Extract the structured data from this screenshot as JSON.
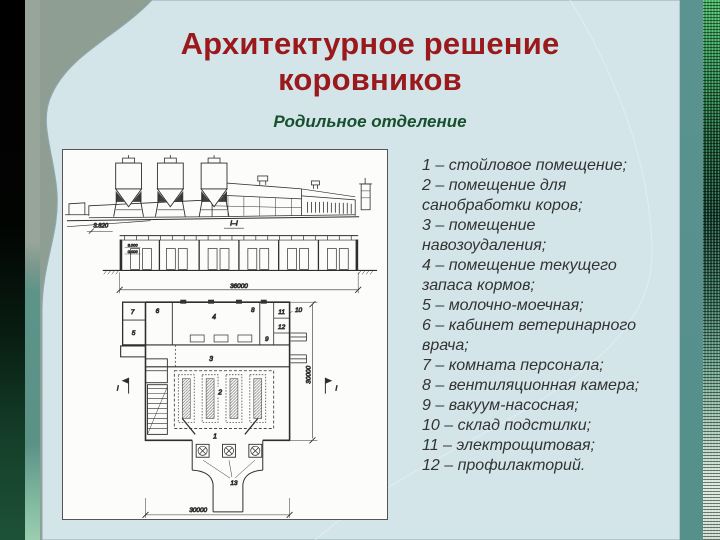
{
  "slide": {
    "title": "Архитектурное решение коровников",
    "subtitle": "Родильное отделение"
  },
  "legend": {
    "items": [
      "1 – стойловое помещение;",
      "2 – помещение для санобработки коров;",
      "3 – помещение навозоудаления;",
      "4 – помещение текущего запаса кормов;",
      "5 – молочно-моечная;",
      "6 – кабинет ветеринарного врача;",
      "7 – комната персонала;",
      "8 – вентиляционная камера;",
      "9 – вакуум-насосная;",
      "10 – склад подстилки;",
      "11 – электрощитовая;",
      "12 – профилакторий."
    ]
  },
  "drawing": {
    "section_mark": "I–I",
    "level_note": "3.820",
    "levels": {
      "upper": "3.000",
      "lower": "0.000"
    },
    "dim_section": "36000",
    "dim_plan_bottom": "30000",
    "dim_plan_right": "30000",
    "marker": "I",
    "rooms": {
      "r1": "1",
      "r2": "2",
      "r3": "3",
      "r4": "4",
      "r5": "5",
      "r6": "6",
      "r7": "7",
      "r8": "8",
      "r9": "9",
      "r10": "10",
      "r11": "11",
      "r12": "12",
      "r13": "13"
    }
  },
  "colors": {
    "title_red": "#9a191d",
    "subtitle_green": "#17502c",
    "background_sage": "#8f9e93",
    "panel_blue": "#d3e5e9",
    "edge_teal": "#57908d"
  }
}
